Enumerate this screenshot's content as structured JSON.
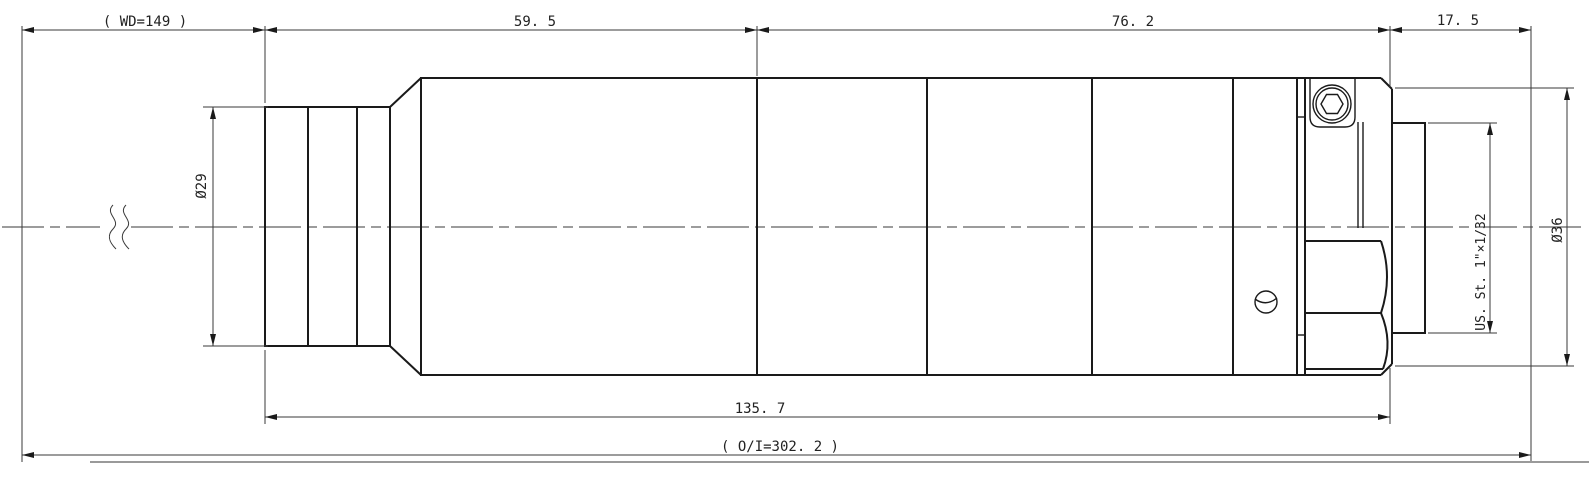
{
  "drawing": {
    "kind": "lens-assembly-dimension-drawing",
    "colors": {
      "outline": "#1a1a1a",
      "dimension": "#3a3a3a",
      "sheet_edge": "#9a9a9a",
      "background": "#ffffff"
    },
    "dimensions": {
      "working_distance": "( WD=149 )",
      "section_a": "59. 5",
      "section_b": "76. 2",
      "flange_distance": "17. 5",
      "front_diameter": "Ø29",
      "outer_diameter": "Ø36",
      "mount_thread": "US. St. 1\"×1/32",
      "body_length": "135. 7",
      "object_to_image": "( O/I=302. 2 )"
    }
  }
}
